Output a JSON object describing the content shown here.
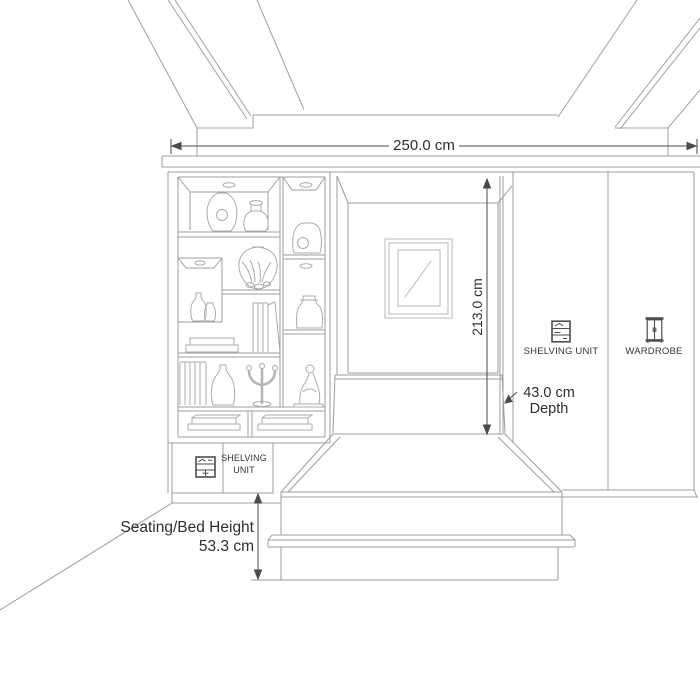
{
  "colors": {
    "background": "#ffffff",
    "line": "#9d9d9d",
    "line_light": "#b5b5b5",
    "line_dark": "#4a4a4a",
    "text": "#2e2e2e"
  },
  "dimensions": {
    "overall_width": "250.0 cm",
    "niche_height": "213.0 cm",
    "depth_value": "43.0 cm",
    "depth_label": "Depth",
    "seat_height_label": "Seating/Bed Height",
    "seat_height_value": "53.3 cm"
  },
  "cabinet_labels": {
    "right_shelving_unit": "SHELVING UNIT",
    "right_wardrobe": "WARDROBE",
    "left_shelving_line1": "SHELVING",
    "left_shelving_line2": "UNIT"
  },
  "icons": {
    "right_shelving_unit": "shelving-unit-icon",
    "right_wardrobe": "wardrobe-icon",
    "left_shelving_unit": "shelving-unit-icon"
  }
}
